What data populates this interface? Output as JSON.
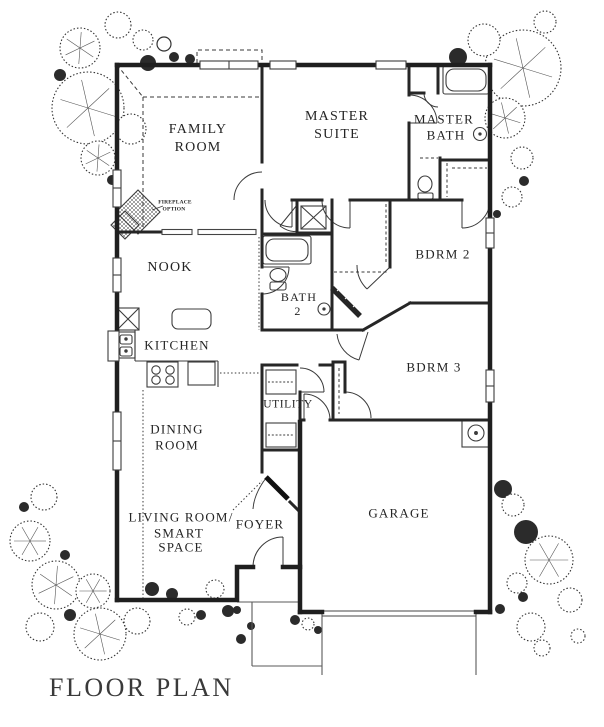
{
  "title": "FLOOR PLAN",
  "rooms": {
    "family_room": {
      "line1": "FAMILY",
      "line2": "ROOM"
    },
    "master_suite": {
      "line1": "MASTER",
      "line2": "SUITE"
    },
    "master_bath": {
      "line1": "MASTER",
      "line2": "BATH"
    },
    "nook": {
      "line1": "NOOK"
    },
    "kitchen": {
      "line1": "KITCHEN"
    },
    "bath2": {
      "line1": "BATH",
      "line2": "2"
    },
    "bdrm2": {
      "line1": "BDRM 2"
    },
    "bdrm3": {
      "line1": "BDRM 3"
    },
    "utility": {
      "line1": "UTILITY"
    },
    "dining": {
      "line1": "DINING",
      "line2": "ROOM"
    },
    "living": {
      "line1": "LIVING ROOM/",
      "line2": "SMART",
      "line3": "SPACE"
    },
    "foyer": {
      "line1": "FOYER"
    },
    "garage": {
      "line1": "GARAGE"
    }
  },
  "annotations": {
    "fireplace": {
      "line1": "FIREPLACE",
      "line2": "OPTION"
    }
  },
  "colors": {
    "ink": "#242424",
    "paper": "#ffffff"
  }
}
